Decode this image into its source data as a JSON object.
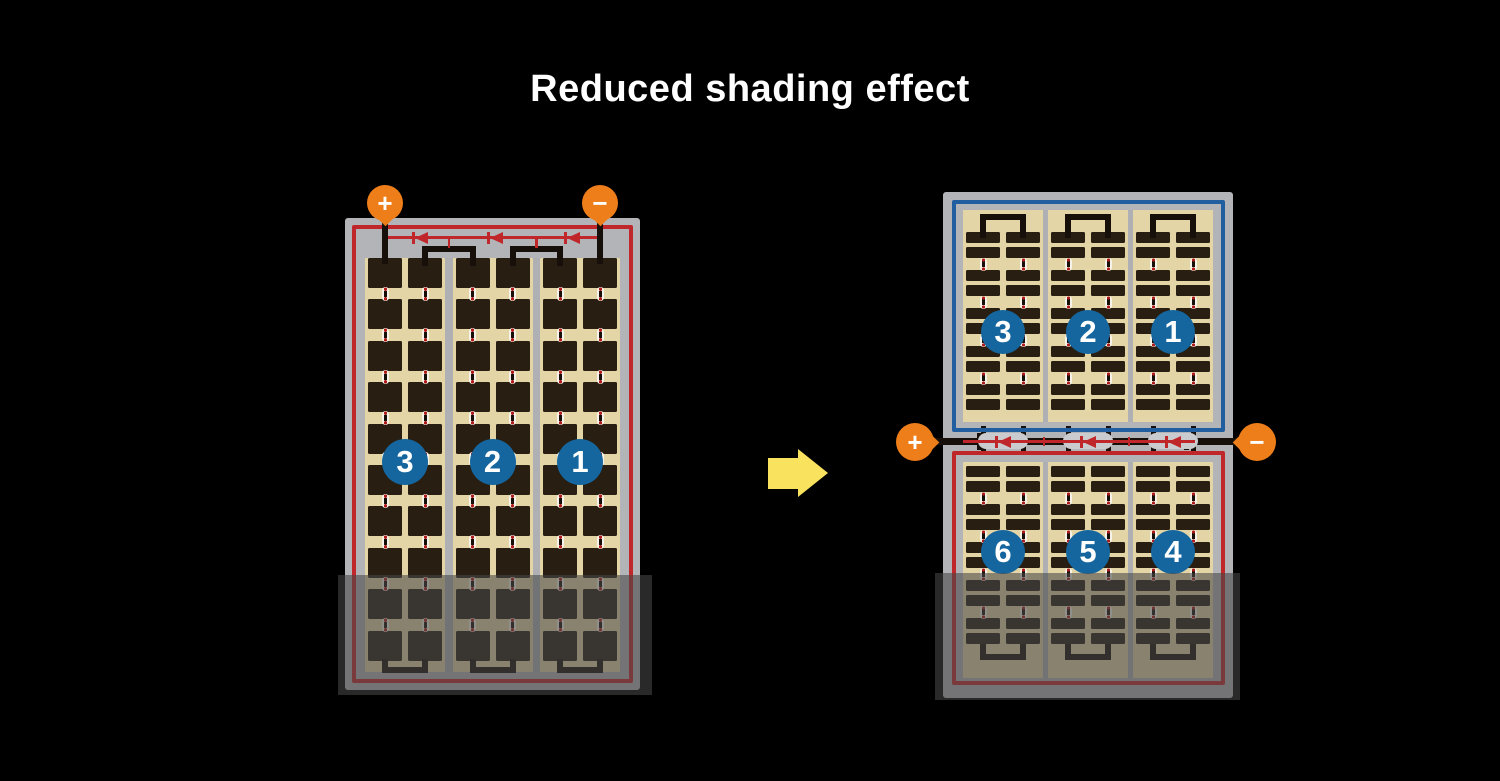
{
  "title": "Reduced shading effect",
  "colors": {
    "bg": "#000000",
    "titleText": "#ffffff",
    "frame": "#b3b4b7",
    "sep": "#aeb0b4",
    "tan": "#e3d5a6",
    "cell": "#281e12",
    "wire": "#17100a",
    "red": "#c0272b",
    "blue": "#215e9f",
    "circle": "#15669e",
    "circleText": "#ffffff",
    "orange": "#ee7e1a",
    "arrow": "#f8e25e",
    "capsule": "#c9cbce",
    "connFill": "#f7f3e8",
    "connDot": "#b01b1b",
    "shade": "rgba(70,70,70,0.58)"
  },
  "left_module": {
    "terminals": {
      "plus": "+",
      "minus": "−"
    },
    "strings": 3,
    "columns_per_string": 2,
    "rows": 10,
    "string_labels": [
      "3",
      "2",
      "1"
    ],
    "bypass_diodes": 3,
    "shaded_region": "bottom"
  },
  "arrow_direction": "right",
  "right_module": {
    "terminals": {
      "plus": "+",
      "minus": "−"
    },
    "bypass_diodes": 3,
    "top_panel": {
      "strings": 3,
      "columns_per_string": 2,
      "rows": 10,
      "string_labels": [
        "3",
        "2",
        "1"
      ]
    },
    "bottom_panel": {
      "strings": 3,
      "columns_per_string": 2,
      "rows": 10,
      "string_labels": [
        "6",
        "5",
        "4"
      ],
      "shaded_region": "bottom"
    }
  }
}
